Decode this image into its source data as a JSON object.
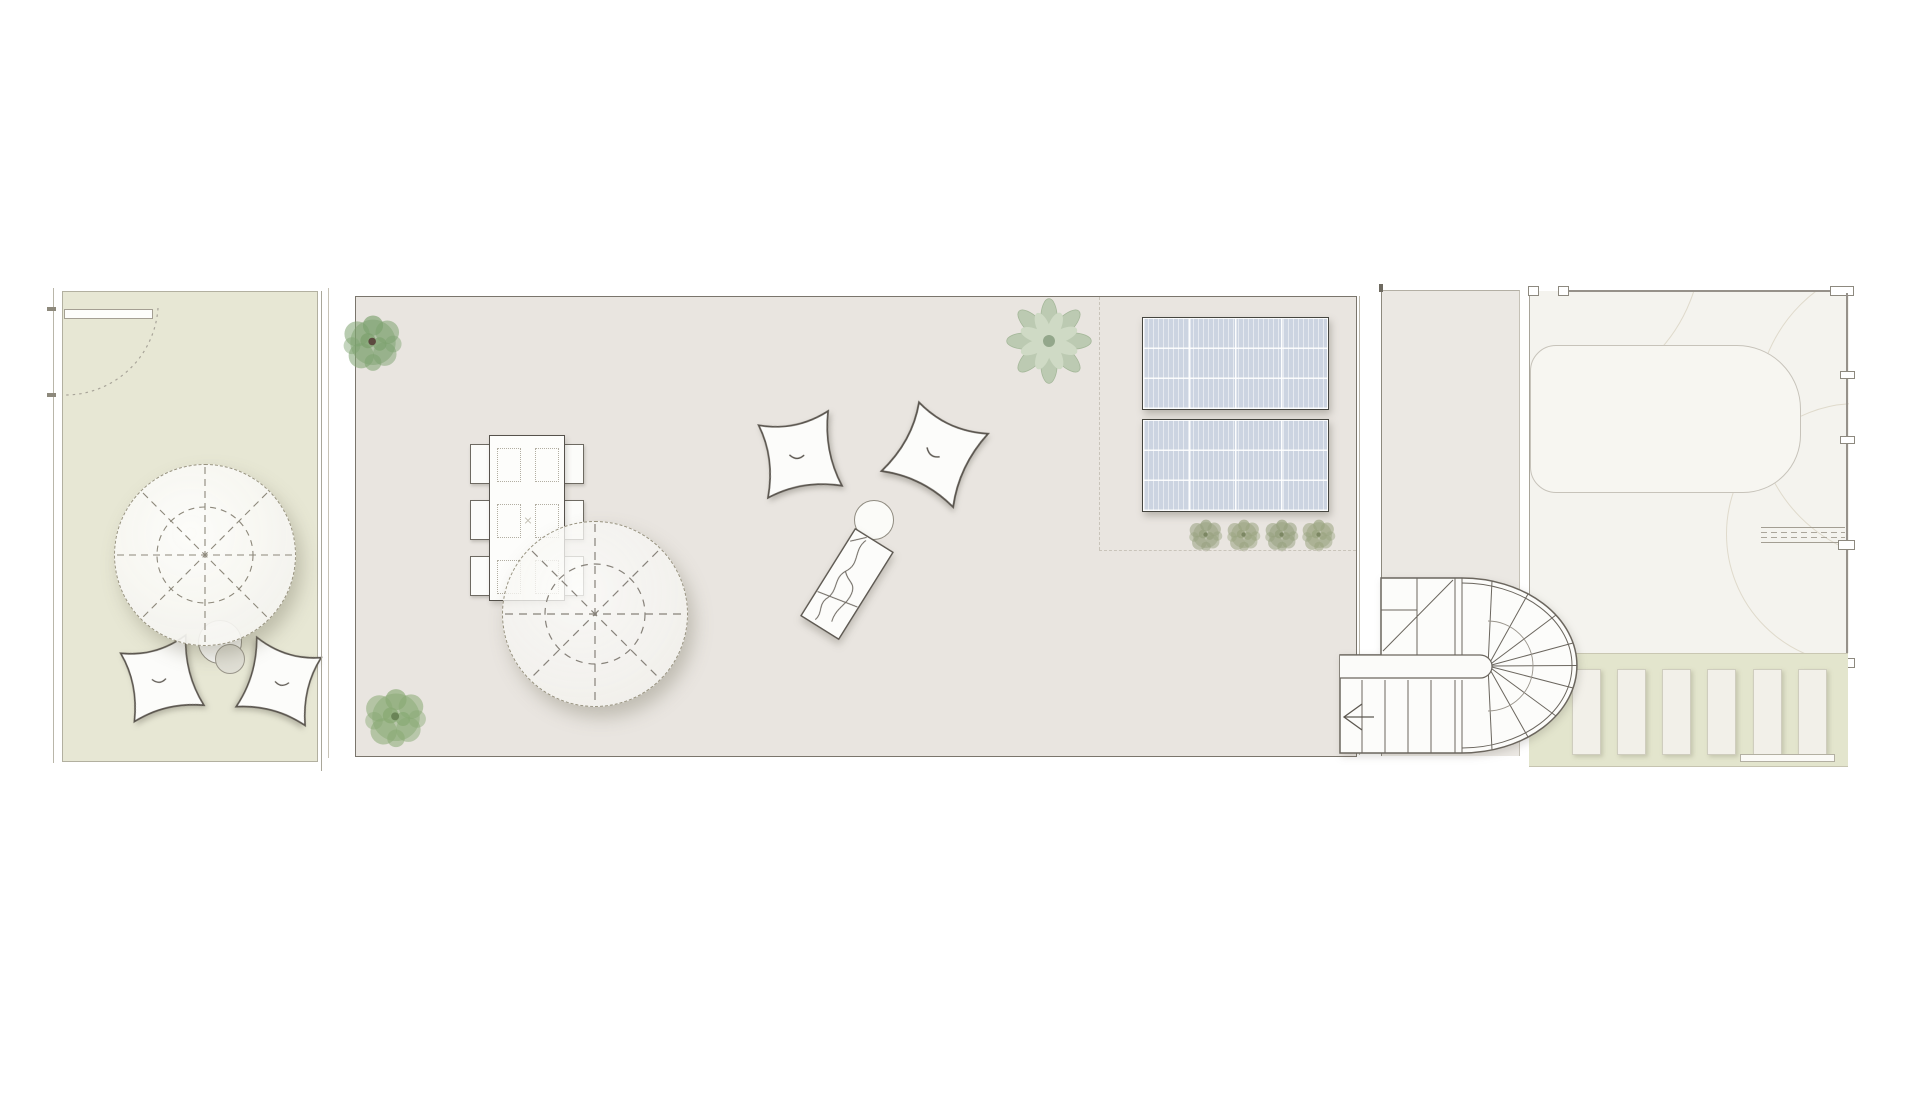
{
  "document": {
    "kind": "architectural floor plan",
    "view": "roof terrace plan (top-down)",
    "visible_text": "none"
  },
  "palette": {
    "page_background": "#ffffff",
    "garden_green": "#e7e7d4",
    "terrace_grey": "#e9e5e0",
    "stair_shaft_grey": "#ebe8e3",
    "room_floor_white": "#f4f3ee",
    "patio_green": "#e3e5cd",
    "solar_panel_blue": "#ccd4e1",
    "drawing_line_dark": "#6b665e",
    "foliage_green": "#7da26f",
    "foliage_olive": "#97a17f",
    "succulent_pale_green": "#bccab2"
  },
  "areas": {
    "left_garden_terrace": {
      "label": "side garden terrace",
      "furniture": [
        "large parasol",
        "round side table",
        "small accent table",
        "butterfly chair",
        "butterfly chair",
        "wall bench"
      ],
      "annotations": [
        "dashed door-swing arc",
        "two wall tick marks"
      ]
    },
    "main_terrace": {
      "label": "main roof terrace",
      "furniture": [
        "dining table with six chairs and six placemats",
        "large parasol",
        "butterfly chair",
        "butterfly chair",
        "round side table",
        "sun lounger with towel"
      ],
      "equipment": [
        "solar panel",
        "solar panel"
      ],
      "planting": [
        "corner shrub top-left",
        "corner shrub bottom-left",
        "potted succulent",
        "hedge row of four shrubs"
      ],
      "annotations": [
        "dashed zone boundary lines"
      ]
    },
    "stair_shaft": {
      "label": "stair shaft strip"
    },
    "staircase": {
      "label": "U-shaped switchback stair with semicircular winder end",
      "flights": 2,
      "direction_arrow": "pointing left",
      "features": [
        "central rounded landing rail",
        "radial winder treads",
        "walk line arc"
      ]
    },
    "roof_room": {
      "label": "enclosed roof room",
      "features": [
        "large rounded skylight",
        "ventilation grille",
        "door opening top-left",
        "window jambs on right wall",
        "faint tree-canopy arcs"
      ]
    },
    "rear_patio": {
      "label": "rear patio strip",
      "features": [
        "six white paving slabs",
        "threshold strip"
      ]
    }
  }
}
